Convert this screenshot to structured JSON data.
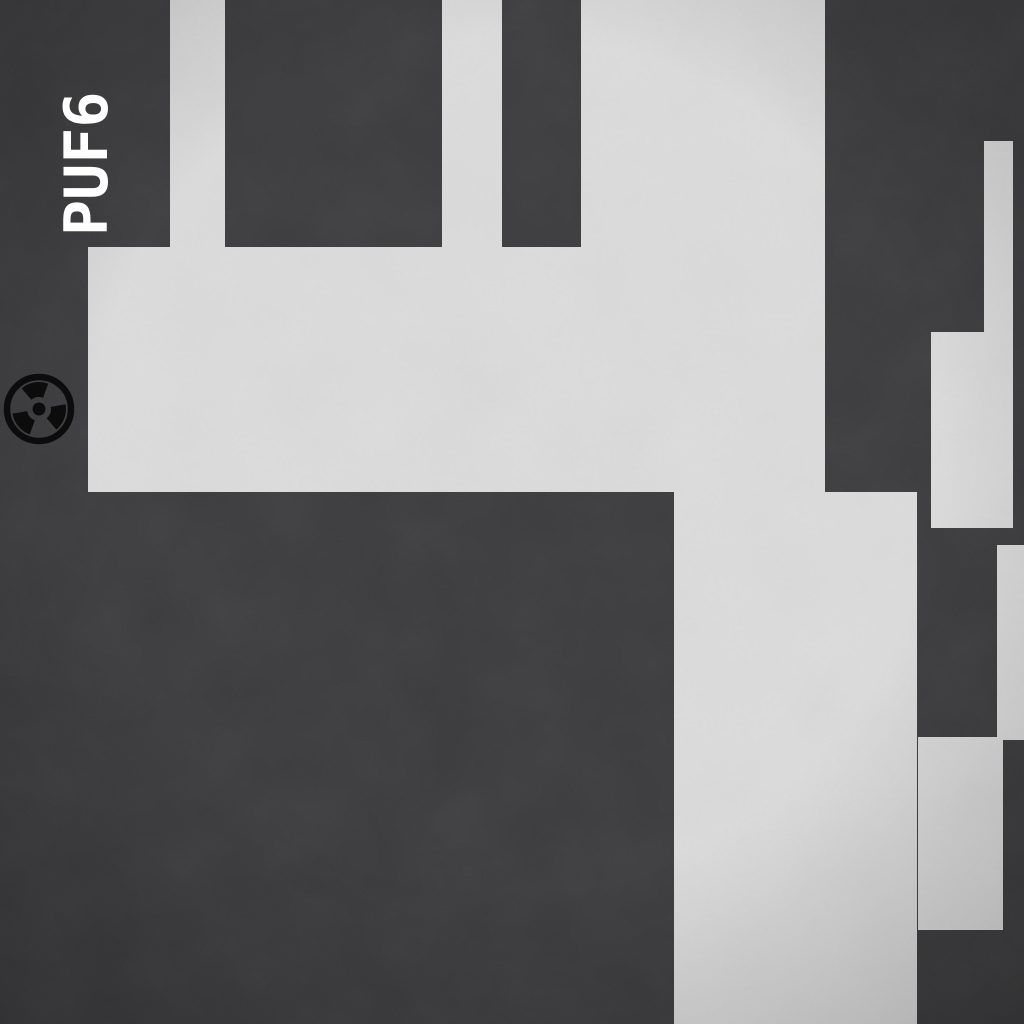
{
  "scene": {
    "type": "top-down level map",
    "label": "PUF6",
    "colors": {
      "background": "#3a3a3c",
      "floor": "#dcdcdd",
      "label_text": "#ffffff",
      "hazard_icon": "#0c0c0c"
    },
    "label_pos": {
      "x": 110,
      "y": 236
    },
    "hazard_marker": {
      "icon": "radiation-icon",
      "cx": 39,
      "cy": 409,
      "outer_radius": 35
    },
    "floor_regions": [
      {
        "x": 170,
        "y": 0,
        "w": 55,
        "h": 247
      },
      {
        "x": 442,
        "y": 0,
        "w": 60,
        "h": 247
      },
      {
        "x": 581,
        "y": 0,
        "w": 244,
        "h": 247
      },
      {
        "x": 88,
        "y": 247,
        "w": 737,
        "h": 245
      },
      {
        "x": 674,
        "y": 492,
        "w": 243,
        "h": 532
      },
      {
        "x": 984,
        "y": 141,
        "w": 29,
        "h": 191
      },
      {
        "x": 931,
        "y": 332,
        "w": 82,
        "h": 196
      },
      {
        "x": 997,
        "y": 545,
        "w": 27,
        "h": 195
      },
      {
        "x": 918,
        "y": 737,
        "w": 85,
        "h": 193
      }
    ]
  }
}
